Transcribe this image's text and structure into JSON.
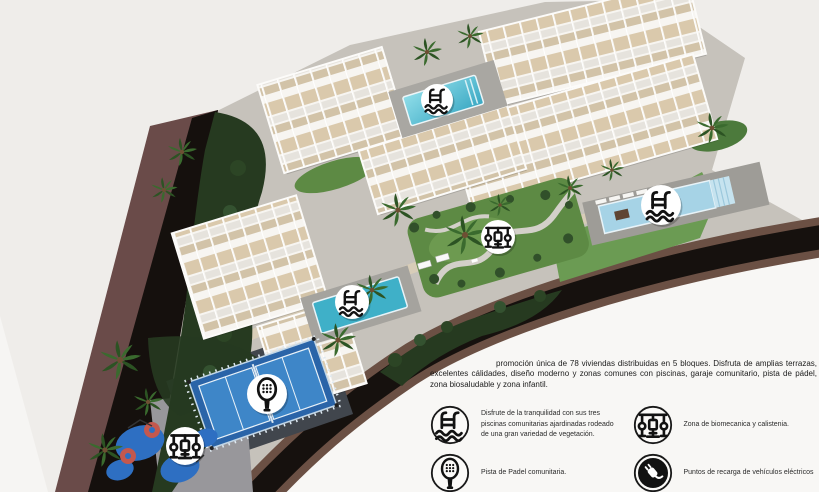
{
  "page": {
    "background_color": "#efedea",
    "white_area_color": "#f8f7f5"
  },
  "description": {
    "text": "promoción única de 78 viviendas distribuidas en 5 bloques. Disfruta de amplias terrazas, excelentes cálidades, diseño moderno y zonas comunes con piscinas, garaje comunitario, pista de pádel, zona biosaludable y zona infantil."
  },
  "legend": {
    "items": [
      {
        "icon": "pool-icon",
        "text": "Disfrute de la tranquilidad con sus tres piscinas comunitarias ajardinadas rodeado de una gran variedad de vegetación."
      },
      {
        "icon": "calisthenics-icon",
        "text": "Zona de biomecanica y calistenia."
      },
      {
        "icon": "padel-icon",
        "text": "Pista de Padel comunitaria."
      },
      {
        "icon": "ev-charger-icon",
        "text": "Puntos de recarga de vehículos eléctricos"
      }
    ]
  },
  "map_markers": [
    {
      "id": "pool-marker-top"
    },
    {
      "id": "pool-marker-right"
    },
    {
      "id": "pool-marker-center"
    },
    {
      "id": "padel-marker"
    },
    {
      "id": "calisthenics-marker"
    },
    {
      "id": "biohealthy-zone-marker"
    }
  ],
  "colors": {
    "pool_water": "#3aa8c3",
    "pool_water_light": "#a6d3e6",
    "padel_court_blue": "#2a64a8",
    "road_asphalt": "#16110e",
    "sidewalk_maroon": "#6a4b49",
    "lawn_green": "#6b9b53",
    "building_terrace_tan": "#dac9ac"
  }
}
